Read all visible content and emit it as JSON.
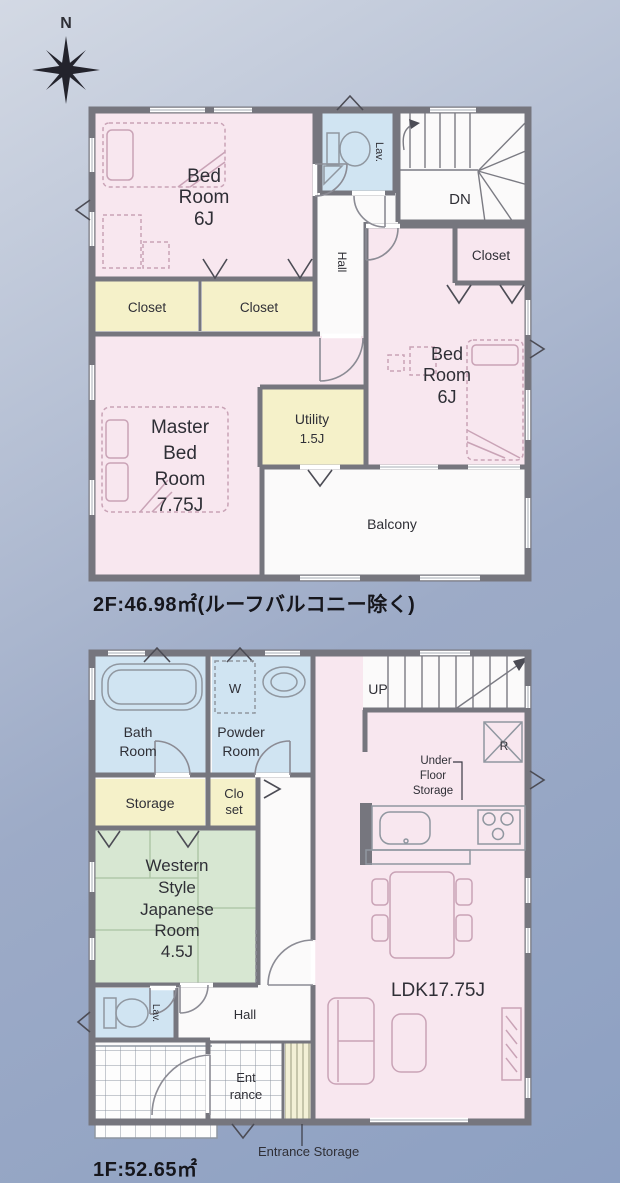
{
  "compass": {
    "label": "N"
  },
  "floor2": {
    "area_label": "2F:46.98㎡(ルーフバルコニー除く)",
    "rooms": {
      "bedroom_left": {
        "lines": [
          "Bed",
          "Room",
          "6J"
        ]
      },
      "closet_a": {
        "label": "Closet"
      },
      "closet_b": {
        "label": "Closet"
      },
      "lav": {
        "label": "Lav."
      },
      "hall": {
        "label": "Hall"
      },
      "stairs_down": {
        "label": "DN"
      },
      "closet_right": {
        "label": "Closet"
      },
      "bedroom_right": {
        "lines": [
          "Bed",
          "Room",
          "6J"
        ]
      },
      "master": {
        "lines": [
          "Master",
          "Bed",
          "Room",
          "7.75J"
        ]
      },
      "utility": {
        "lines": [
          "Utility",
          "1.5J"
        ]
      },
      "balcony": {
        "label": "Balcony"
      }
    }
  },
  "floor1": {
    "area_label": "1F:52.65㎡",
    "rooms": {
      "bath": {
        "lines": [
          "Bath",
          "Room"
        ]
      },
      "powder": {
        "lines": [
          "Powder",
          "Room"
        ]
      },
      "washer": {
        "label": "W"
      },
      "storage": {
        "label": "Storage"
      },
      "closet": {
        "lines": [
          "Clo",
          "set"
        ]
      },
      "japanese": {
        "lines": [
          "Western",
          "Style",
          "Japanese",
          "Room",
          "4.5J"
        ]
      },
      "lav": {
        "label": "Lav."
      },
      "hall": {
        "label": "Hall"
      },
      "stairs_up": {
        "label": "UP"
      },
      "fridge": {
        "label": "R"
      },
      "under_floor": {
        "lines": [
          "Under",
          "Floor",
          "Storage"
        ]
      },
      "ldk": {
        "label": "LDK17.75J"
      },
      "entrance": {
        "lines": [
          "Ent",
          "rance"
        ]
      },
      "entrance_storage": {
        "label": "Entrance Storage"
      }
    }
  },
  "colors": {
    "bg_top": "#d3d9e4",
    "bg_mid": "#9dabc7",
    "bg_bottom": "#8da0c2",
    "plan": "#fbfafa",
    "wall": "#76767e",
    "room_pink": "#f8e7ef",
    "room_yellow": "#f5f1c9",
    "room_blue": "#d0e4f2",
    "room_green": "#d7e7d2",
    "text": "#2f2f36",
    "furniture": "#9097a0",
    "furniture_pink": "#c9a3b6"
  }
}
